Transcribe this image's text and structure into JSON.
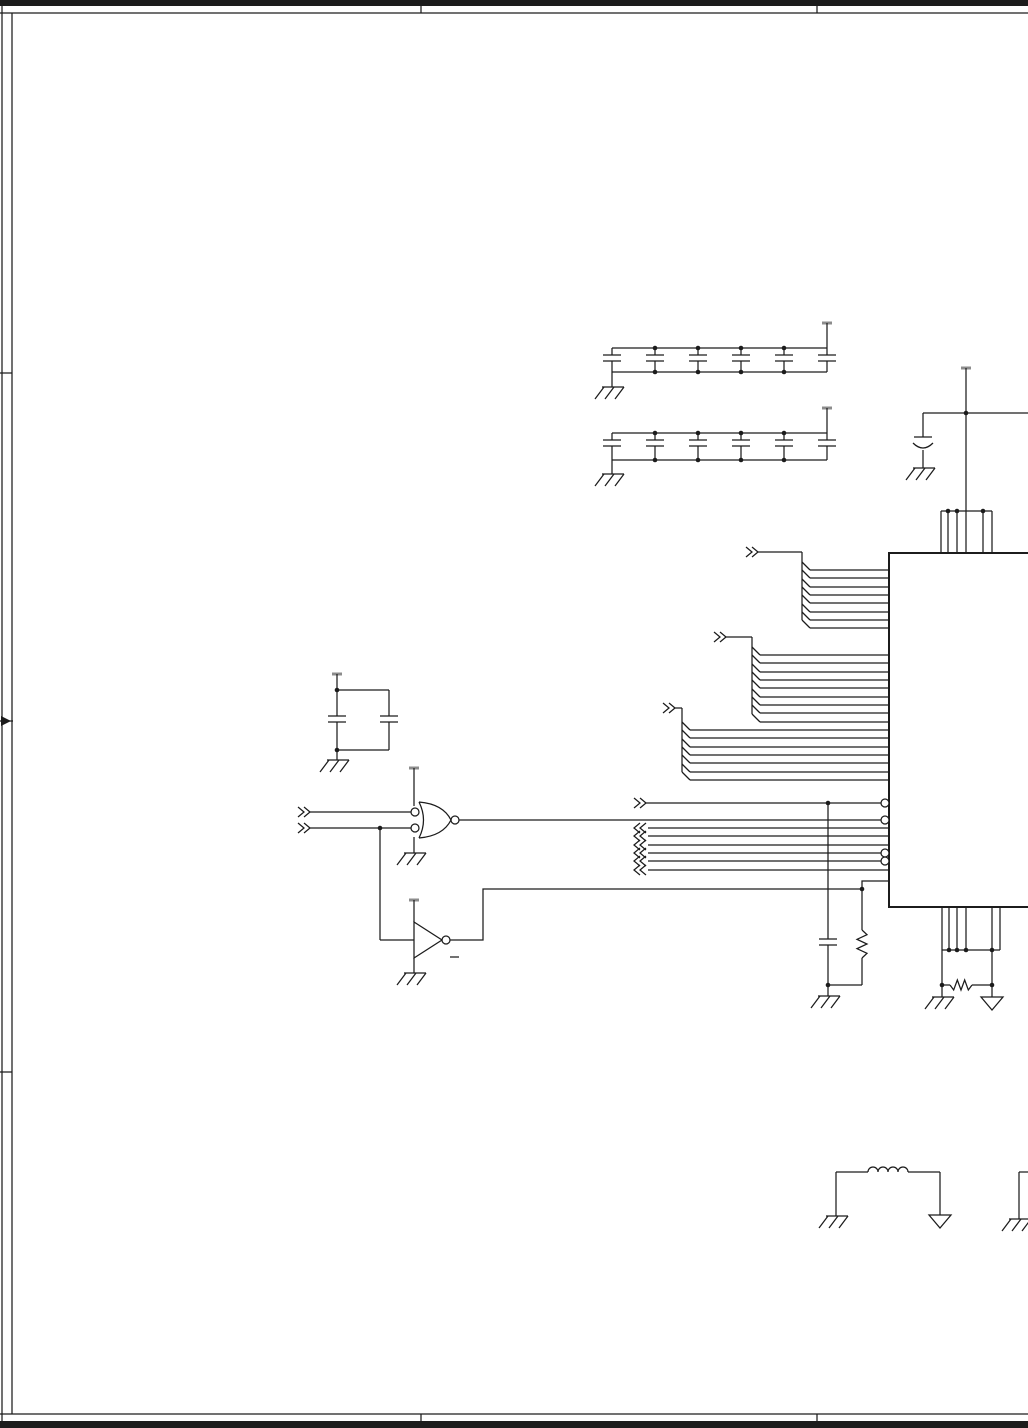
{
  "page": {
    "width": 1028,
    "height": 1428,
    "kind": "schematic-sheet"
  },
  "colors": {
    "ink": "#1c1c1c",
    "bg": "#ffffff",
    "pwr_bar": "#8c8c8c"
  },
  "schematic": {
    "primitives": [
      {
        "t": "rect",
        "n": "title-bar-top",
        "x": 0,
        "y": 0,
        "w": 1028,
        "h": 6
      },
      {
        "t": "line",
        "n": "title-bar-top-rule",
        "x1": 0,
        "y1": 13,
        "x2": 1028,
        "y2": 13
      },
      {
        "t": "line",
        "n": "title-bar-divider",
        "x1": 421,
        "y1": 0,
        "x2": 421,
        "y2": 13
      },
      {
        "t": "line",
        "n": "title-bar-divider",
        "x1": 817,
        "y1": 0,
        "x2": 817,
        "y2": 13
      },
      {
        "t": "line",
        "n": "border-left-outer",
        "x1": 2,
        "y1": 0,
        "x2": 2,
        "y2": 1428
      },
      {
        "t": "line",
        "n": "border-left-inner",
        "x1": 12,
        "y1": 13,
        "x2": 12,
        "y2": 1414
      },
      {
        "t": "line",
        "n": "fold-tick",
        "x1": 0,
        "y1": 373,
        "x2": 12,
        "y2": 373
      },
      {
        "t": "line",
        "n": "fold-tick",
        "x1": 0,
        "y1": 1072,
        "x2": 12,
        "y2": 1072
      },
      {
        "t": "arrow",
        "n": "center-arrow-marker",
        "x": 0,
        "y": 721
      },
      {
        "t": "line",
        "n": "title-bar-bottom-rule",
        "x1": 0,
        "y1": 1414,
        "x2": 1028,
        "y2": 1414
      },
      {
        "t": "rect",
        "n": "title-bar-bottom",
        "x": 0,
        "y": 1421,
        "w": 1028,
        "h": 7
      },
      {
        "t": "line",
        "n": "title-bar-divider",
        "x1": 421,
        "y1": 1414,
        "x2": 421,
        "y2": 1421
      },
      {
        "t": "line",
        "n": "title-bar-divider",
        "x1": 817,
        "y1": 1414,
        "x2": 817,
        "y2": 1421
      },
      {
        "t": "capbank",
        "n": "decoupling-cap-bank-1",
        "xs": [
          612,
          655,
          698,
          741,
          784,
          827
        ],
        "yt": 348,
        "yb": 372,
        "yp": 355
      },
      {
        "t": "pwr",
        "x": 827,
        "y": 323,
        "y2": 348
      },
      {
        "t": "line",
        "x1": 612,
        "y1": 372,
        "x2": 612,
        "y2": 387
      },
      {
        "t": "gnd",
        "x": 612,
        "y": 387
      },
      {
        "t": "dot",
        "x": 655,
        "y": 348
      },
      {
        "t": "dot",
        "x": 698,
        "y": 348
      },
      {
        "t": "dot",
        "x": 741,
        "y": 348
      },
      {
        "t": "dot",
        "x": 784,
        "y": 348
      },
      {
        "t": "dot",
        "x": 655,
        "y": 372
      },
      {
        "t": "dot",
        "x": 698,
        "y": 372
      },
      {
        "t": "dot",
        "x": 741,
        "y": 372
      },
      {
        "t": "dot",
        "x": 784,
        "y": 372
      },
      {
        "t": "capbank",
        "n": "decoupling-cap-bank-2",
        "xs": [
          612,
          655,
          698,
          741,
          784,
          827
        ],
        "yt": 433,
        "yb": 460,
        "yp": 440
      },
      {
        "t": "pwr",
        "x": 827,
        "y": 408,
        "y2": 433
      },
      {
        "t": "line",
        "x1": 612,
        "y1": 460,
        "x2": 612,
        "y2": 474
      },
      {
        "t": "gnd",
        "x": 612,
        "y": 474
      },
      {
        "t": "dot",
        "x": 655,
        "y": 433
      },
      {
        "t": "dot",
        "x": 698,
        "y": 433
      },
      {
        "t": "dot",
        "x": 741,
        "y": 433
      },
      {
        "t": "dot",
        "x": 784,
        "y": 433
      },
      {
        "t": "dot",
        "x": 655,
        "y": 460
      },
      {
        "t": "dot",
        "x": 698,
        "y": 460
      },
      {
        "t": "dot",
        "x": 741,
        "y": 460
      },
      {
        "t": "dot",
        "x": 784,
        "y": 460
      },
      {
        "t": "pwr",
        "x": 966,
        "y": 368,
        "y2": 413
      },
      {
        "t": "line",
        "n": "vdd-rail",
        "x1": 923,
        "y1": 413,
        "x2": 1028,
        "y2": 413
      },
      {
        "t": "dot",
        "x": 966,
        "y": 413
      },
      {
        "t": "line",
        "x1": 966,
        "y1": 413,
        "x2": 966,
        "y2": 511
      },
      {
        "t": "line",
        "x1": 923,
        "y1": 413,
        "x2": 923,
        "y2": 437
      },
      {
        "t": "pcap",
        "n": "bulk-capacitor",
        "x": 923,
        "y": 437
      },
      {
        "t": "line",
        "x1": 923,
        "y1": 450,
        "x2": 923,
        "y2": 468
      },
      {
        "t": "gnd",
        "x": 923,
        "y": 468
      },
      {
        "t": "line",
        "n": "pin-rail",
        "x1": 941,
        "y1": 511,
        "x2": 992,
        "y2": 511
      },
      {
        "t": "vpins",
        "n": "ic-power-pins",
        "xs": [
          941,
          948,
          957,
          966,
          983,
          992
        ],
        "y1": 511,
        "y2": 553
      },
      {
        "t": "dot",
        "x": 948,
        "y": 511
      },
      {
        "t": "dot",
        "x": 957,
        "y": 511
      },
      {
        "t": "dot",
        "x": 983,
        "y": 511
      },
      {
        "t": "poly",
        "n": "ic-body",
        "w": 2,
        "pts": [
          [
            1028,
            553
          ],
          [
            889,
            553
          ],
          [
            889,
            907
          ],
          [
            1028,
            907
          ]
        ]
      },
      {
        "t": "busfan",
        "n": "address-bus-fan",
        "cx": 746,
        "cy": 552,
        "vx": 802,
        "xe": 889,
        "ys": [
          570,
          578,
          587,
          595,
          603,
          612,
          620,
          628
        ]
      },
      {
        "t": "busfan",
        "n": "address-bus-fan",
        "cx": 714,
        "cy": 637,
        "vx": 752,
        "xe": 889,
        "ys": [
          655,
          663,
          672,
          680,
          688,
          697,
          705,
          713,
          722
        ]
      },
      {
        "t": "busfan",
        "n": "data-bus-fan",
        "cx": 663,
        "cy": 708,
        "vx": 682,
        "xe": 889,
        "ys": [
          730,
          738,
          747,
          755,
          763,
          772,
          780
        ]
      },
      {
        "t": "chevR",
        "x": 634,
        "y": 803
      },
      {
        "t": "line",
        "n": "signal-wire",
        "x1": 646,
        "y1": 803,
        "x2": 881,
        "y2": 803
      },
      {
        "t": "bubble",
        "x": 885,
        "y": 803
      },
      {
        "t": "dot",
        "x": 828,
        "y": 803
      },
      {
        "t": "chevL",
        "x": 634,
        "y": 828
      },
      {
        "t": "line",
        "n": "signal-wire",
        "x1": 648,
        "y1": 828,
        "x2": 889,
        "y2": 828
      },
      {
        "t": "chevL",
        "x": 634,
        "y": 836
      },
      {
        "t": "line",
        "n": "signal-wire",
        "x1": 648,
        "y1": 836,
        "x2": 889,
        "y2": 836
      },
      {
        "t": "chevL",
        "x": 634,
        "y": 845
      },
      {
        "t": "line",
        "n": "signal-wire",
        "x1": 648,
        "y1": 845,
        "x2": 889,
        "y2": 845
      },
      {
        "t": "chevL",
        "x": 634,
        "y": 853
      },
      {
        "t": "line",
        "n": "signal-wire",
        "x1": 648,
        "y1": 853,
        "x2": 881,
        "y2": 853
      },
      {
        "t": "bubble",
        "x": 885,
        "y": 853
      },
      {
        "t": "chevL",
        "x": 634,
        "y": 861
      },
      {
        "t": "line",
        "n": "signal-wire",
        "x1": 648,
        "y1": 861,
        "x2": 881,
        "y2": 861
      },
      {
        "t": "bubble",
        "x": 885,
        "y": 861
      },
      {
        "t": "chevL",
        "x": 634,
        "y": 870
      },
      {
        "t": "line",
        "n": "signal-wire",
        "x1": 648,
        "y1": 870,
        "x2": 889,
        "y2": 870
      },
      {
        "t": "chevR",
        "x": 298,
        "y": 812
      },
      {
        "t": "chevR",
        "x": 298,
        "y": 828
      },
      {
        "t": "line",
        "n": "gate-input-wire",
        "x1": 310,
        "y1": 812,
        "x2": 411,
        "y2": 812
      },
      {
        "t": "line",
        "n": "gate-input-wire",
        "x1": 310,
        "y1": 828,
        "x2": 411,
        "y2": 828
      },
      {
        "t": "bubble",
        "x": 415,
        "y": 812
      },
      {
        "t": "bubble",
        "x": 415,
        "y": 828
      },
      {
        "t": "orgate",
        "n": "nor-gate",
        "x": 419,
        "y": 820
      },
      {
        "t": "bubble",
        "x": 455,
        "y": 820
      },
      {
        "t": "line",
        "n": "gate-output-wire",
        "x1": 459,
        "y1": 820,
        "x2": 881,
        "y2": 820
      },
      {
        "t": "bubble",
        "x": 885,
        "y": 820
      },
      {
        "t": "pwr",
        "x": 414,
        "y": 768,
        "y2": 806
      },
      {
        "t": "line",
        "x1": 414,
        "y1": 837,
        "x2": 414,
        "y2": 853
      },
      {
        "t": "gnd",
        "x": 414,
        "y": 853
      },
      {
        "t": "dot",
        "x": 380,
        "y": 828
      },
      {
        "t": "line",
        "x1": 380,
        "y1": 828,
        "x2": 380,
        "y2": 940
      },
      {
        "t": "line",
        "x1": 380,
        "y1": 940,
        "x2": 414,
        "y2": 940
      },
      {
        "t": "capbank",
        "n": "bypass-cap-pair",
        "xs": [
          337,
          389
        ],
        "yt": 690,
        "yb": 750,
        "yp": 716
      },
      {
        "t": "pwr",
        "x": 337,
        "y": 674,
        "y2": 690
      },
      {
        "t": "dot",
        "x": 337,
        "y": 690
      },
      {
        "t": "dot",
        "x": 337,
        "y": 750
      },
      {
        "t": "line",
        "x1": 337,
        "y1": 750,
        "x2": 337,
        "y2": 760
      },
      {
        "t": "gnd",
        "x": 337,
        "y": 760
      },
      {
        "t": "inv",
        "n": "inverter",
        "x": 414,
        "y": 940
      },
      {
        "t": "bubble",
        "x": 446,
        "y": 940
      },
      {
        "t": "pwr",
        "x": 414,
        "y": 900,
        "y2": 922
      },
      {
        "t": "line",
        "x1": 414,
        "y1": 958,
        "x2": 414,
        "y2": 973
      },
      {
        "t": "gnd",
        "x": 414,
        "y": 973
      },
      {
        "t": "line",
        "n": "label-tick",
        "x1": 450,
        "y1": 957,
        "x2": 459,
        "y2": 957
      },
      {
        "t": "poly",
        "n": "inverter-output-wire",
        "pts": [
          [
            450,
            940
          ],
          [
            483,
            940
          ],
          [
            483,
            889
          ],
          [
            862,
            889
          ],
          [
            862,
            881
          ],
          [
            889,
            881
          ]
        ]
      },
      {
        "t": "dot",
        "x": 862,
        "y": 889
      },
      {
        "t": "line",
        "x1": 862,
        "y1": 889,
        "x2": 862,
        "y2": 930
      },
      {
        "t": "resv",
        "n": "resistor",
        "x": 862,
        "y1": 930,
        "y2": 958
      },
      {
        "t": "line",
        "x1": 862,
        "y1": 958,
        "x2": 862,
        "y2": 985
      },
      {
        "t": "line",
        "x1": 828,
        "y1": 985,
        "x2": 862,
        "y2": 985
      },
      {
        "t": "line",
        "x1": 828,
        "y1": 803,
        "x2": 828,
        "y2": 939
      },
      {
        "t": "cap",
        "n": "filter-capacitor",
        "x": 828,
        "y": 939
      },
      {
        "t": "line",
        "x1": 828,
        "y1": 945,
        "x2": 828,
        "y2": 985
      },
      {
        "t": "dot",
        "x": 828,
        "y": 985
      },
      {
        "t": "line",
        "x1": 828,
        "y1": 985,
        "x2": 828,
        "y2": 996
      },
      {
        "t": "gnd",
        "x": 828,
        "y": 996
      },
      {
        "t": "vpins",
        "n": "ic-ground-pins",
        "xs": [
          942,
          949,
          957,
          966,
          992,
          1000
        ],
        "y1": 907,
        "y2": 950
      },
      {
        "t": "line",
        "n": "pin-rail",
        "x1": 942,
        "y1": 950,
        "x2": 1000,
        "y2": 950
      },
      {
        "t": "dot",
        "x": 949,
        "y": 950
      },
      {
        "t": "dot",
        "x": 957,
        "y": 950
      },
      {
        "t": "dot",
        "x": 966,
        "y": 950
      },
      {
        "t": "dot",
        "x": 992,
        "y": 950
      },
      {
        "t": "line",
        "x1": 942,
        "y1": 950,
        "x2": 942,
        "y2": 985
      },
      {
        "t": "line",
        "x1": 992,
        "y1": 950,
        "x2": 992,
        "y2": 985
      },
      {
        "t": "line",
        "x1": 942,
        "y1": 985,
        "x2": 950,
        "y2": 985
      },
      {
        "t": "resh",
        "n": "resistor",
        "y": 985,
        "x1": 950,
        "x2": 972
      },
      {
        "t": "line",
        "x1": 972,
        "y1": 985,
        "x2": 992,
        "y2": 985
      },
      {
        "t": "dot",
        "x": 942,
        "y": 985
      },
      {
        "t": "dot",
        "x": 992,
        "y": 985
      },
      {
        "t": "line",
        "x1": 942,
        "y1": 985,
        "x2": 942,
        "y2": 997
      },
      {
        "t": "gnd",
        "x": 942,
        "y": 997
      },
      {
        "t": "line",
        "x1": 992,
        "y1": 985,
        "x2": 992,
        "y2": 997
      },
      {
        "t": "tgnd",
        "x": 992,
        "y": 997
      },
      {
        "t": "line",
        "x1": 836,
        "y1": 1172,
        "x2": 868,
        "y2": 1172
      },
      {
        "t": "ind",
        "n": "inductor",
        "x1": 868,
        "x2": 908,
        "y": 1172
      },
      {
        "t": "line",
        "x1": 908,
        "y1": 1172,
        "x2": 940,
        "y2": 1172
      },
      {
        "t": "line",
        "x1": 836,
        "y1": 1172,
        "x2": 836,
        "y2": 1216
      },
      {
        "t": "gnd",
        "x": 836,
        "y": 1216
      },
      {
        "t": "line",
        "x1": 940,
        "y1": 1172,
        "x2": 940,
        "y2": 1215
      },
      {
        "t": "tgnd",
        "x": 940,
        "y": 1215
      },
      {
        "t": "line",
        "x1": 1019,
        "y1": 1172,
        "x2": 1028,
        "y2": 1172
      },
      {
        "t": "line",
        "x1": 1019,
        "y1": 1172,
        "x2": 1019,
        "y2": 1219
      },
      {
        "t": "gnd",
        "x": 1019,
        "y": 1219
      }
    ]
  }
}
